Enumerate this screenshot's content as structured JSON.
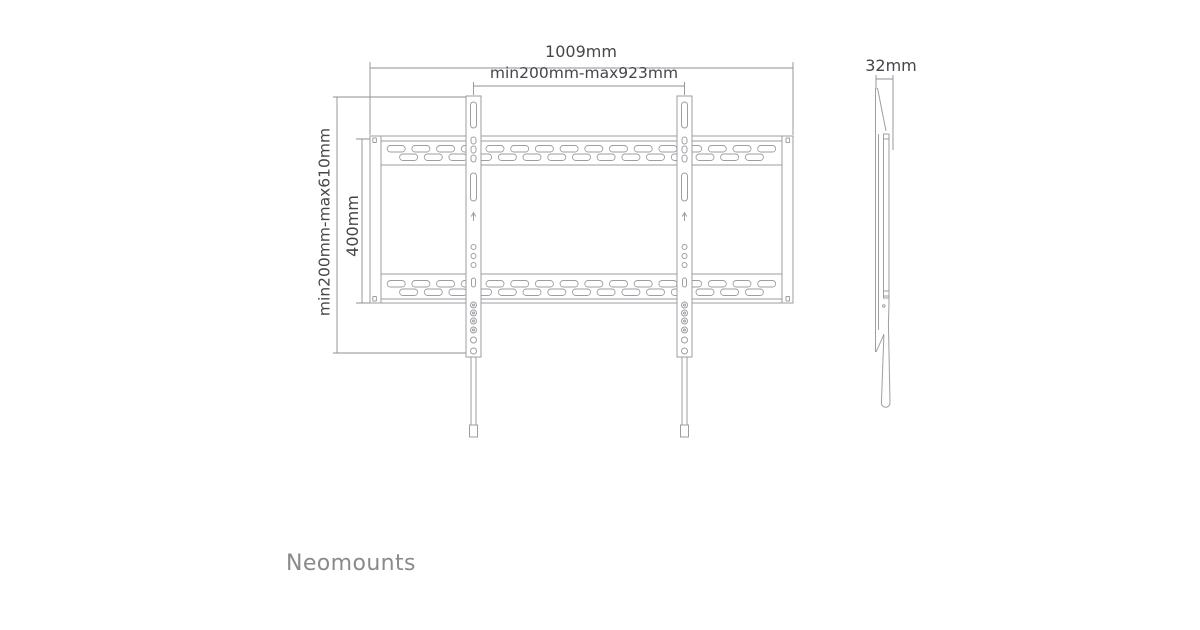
{
  "colors": {
    "line": "#9d9ea3",
    "dim_line": "#8e8f94",
    "text": "#45454b",
    "brand": "#8a8a8e"
  },
  "brand": {
    "wordmark": "Neomounts"
  },
  "front_view": {
    "dimensions": {
      "total_width": "1009mm",
      "mount_width_range": "min200mm-max923mm",
      "mount_height_range": "min200mm-max610mm",
      "plate_height": "400mm"
    }
  },
  "side_view": {
    "dimensions": {
      "depth": "32mm"
    }
  }
}
